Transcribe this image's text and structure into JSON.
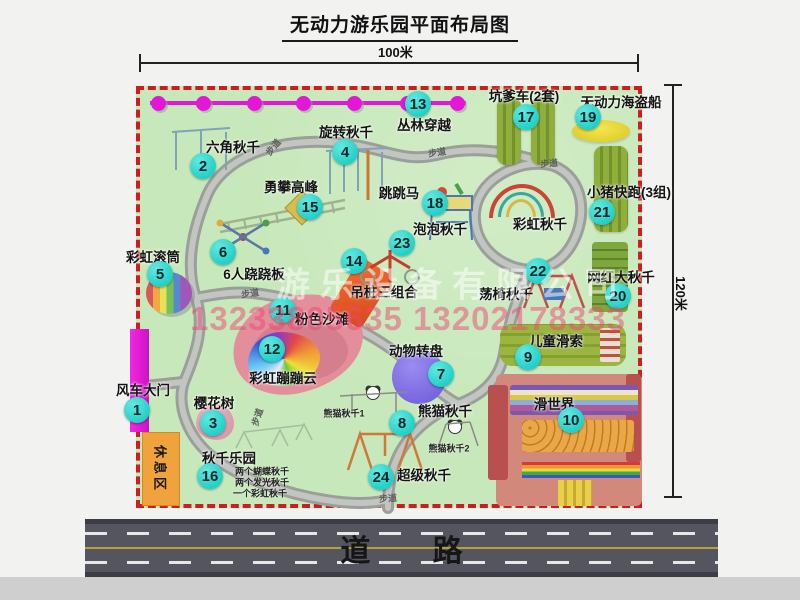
{
  "title": "无动力游乐园平面布局图",
  "dimensions": {
    "width_label": "100米",
    "height_label": "120米"
  },
  "road": {
    "label": "道 路"
  },
  "watermark": {
    "company": "游乐设备有限公司",
    "phones": "13233805635 13202178333"
  },
  "path_label": "步道",
  "rest_area": {
    "label": "休息区"
  },
  "rainbow_swing_label": "彩虹秋千",
  "attractions": [
    {
      "num": "1",
      "label": "风车大门"
    },
    {
      "num": "2",
      "label": "六角秋千"
    },
    {
      "num": "3",
      "label": "樱花树"
    },
    {
      "num": "4",
      "label": "旋转秋千"
    },
    {
      "num": "5",
      "label": "彩虹滚筒"
    },
    {
      "num": "6",
      "label": "6人跷跷板"
    },
    {
      "num": "7",
      "label": "动物转盘"
    },
    {
      "num": "8",
      "label": "熊猫秋千"
    },
    {
      "num": "9",
      "label": "儿童滑索"
    },
    {
      "num": "10",
      "label": "滑世界"
    },
    {
      "num": "11",
      "label": "粉色沙滩"
    },
    {
      "num": "12",
      "label": "彩虹蹦蹦云"
    },
    {
      "num": "13",
      "label": "丛林穿越"
    },
    {
      "num": "14",
      "label": "吊桩三组合"
    },
    {
      "num": "15",
      "label": "勇攀高峰"
    },
    {
      "num": "16",
      "label": "秋千乐园"
    },
    {
      "num": "17",
      "label": "坑爹车(2套)"
    },
    {
      "num": "18",
      "label": "跳跳马"
    },
    {
      "num": "19",
      "label": "无动力海盗船"
    },
    {
      "num": "20",
      "label": "网红大秋千"
    },
    {
      "num": "21",
      "label": "小猪快跑(3组)"
    },
    {
      "num": "22",
      "label": "荡椅秋千"
    },
    {
      "num": "23",
      "label": "泡泡秋千"
    },
    {
      "num": "24",
      "label": "超级秋千"
    }
  ],
  "swing_park_notes": [
    "两个蝴蝶秋千",
    "两个发光秋千",
    "一个彩虹秋千"
  ],
  "panda_subs": [
    "熊猫秋千1",
    "熊猫秋千2"
  ]
}
